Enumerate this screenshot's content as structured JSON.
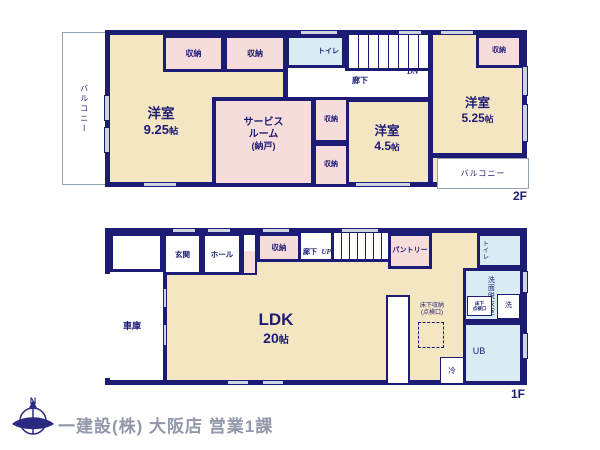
{
  "colors": {
    "wall_navy": "#1c1c74",
    "room_cream": "#f5e6c3",
    "room_pink": "#f7dcdc",
    "room_wet_blue": "#d9ecf4",
    "window_gray": "#cdd5e3",
    "footer_gray": "#9298aa"
  },
  "shared": {
    "closet": "収納",
    "toilet": "トイレ",
    "corridor": "廊下",
    "balcony": "バルコニー",
    "dn": "DN",
    "up": "UP",
    "jo": "帖"
  },
  "floor2": {
    "label": "2F",
    "room_925": {
      "name": "洋室",
      "size": "9.25"
    },
    "service_room": {
      "line1": "サービス",
      "line2": "ルーム",
      "line3": "(納戸)"
    },
    "room_45": {
      "name": "洋室",
      "size": "4.5"
    },
    "room_525": {
      "name": "洋室",
      "size": "5.25"
    }
  },
  "floor1": {
    "label": "1F",
    "entrance": "玄関",
    "hall": "ホール",
    "pantry": "パントリー",
    "washroom": "洗面脱衣室",
    "floor_hatch": {
      "line1": "床下",
      "line2": "点検口"
    },
    "washer": "洗",
    "unit_bath": "UB",
    "fridge": "冷",
    "underfloor_storage": {
      "line1": "床下収納",
      "line2": "(点検口)"
    },
    "ldk": {
      "name": "LDK",
      "size": "20"
    },
    "garage": "車庫"
  },
  "footer": {
    "company": "一建設(株) 大阪店 営業1課",
    "compass_north": "N"
  }
}
